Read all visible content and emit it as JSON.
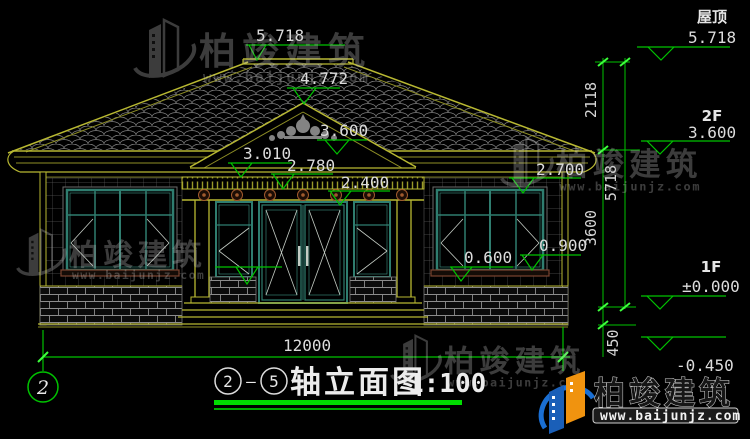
{
  "watermark": {
    "brand": "柏竣建筑",
    "url": "www.baijunjz.com"
  },
  "brand_logo": {
    "brand": "柏竣建筑",
    "url": "www.baijunjz.com"
  },
  "title": {
    "axis_start": "2",
    "axis_end": "5",
    "separator": "—",
    "name": "轴立面图",
    "scale": "1:100"
  },
  "axis_bubble": "2",
  "dims": {
    "total_width": "12000",
    "ridge_to_eave": "2118",
    "total_height": "5718",
    "eave_to_floor": "3600",
    "plinth": "450"
  },
  "marks": {
    "ridge": "5.718",
    "pediment_apex": "4.772",
    "pediment_base": "3.600",
    "eave_top": "3.010",
    "cornice": "2.780",
    "porch_beam": "2.400",
    "right_eave": "2.700",
    "sill_high": "0.900",
    "sill_low": "0.600"
  },
  "levels": {
    "roof_label": "屋顶",
    "roof_value": "5.718",
    "f2_label": "2F",
    "f2_value": "3.600",
    "f1_label": "1F",
    "f1_value": "±0.000",
    "ground_value": "-0.450"
  }
}
